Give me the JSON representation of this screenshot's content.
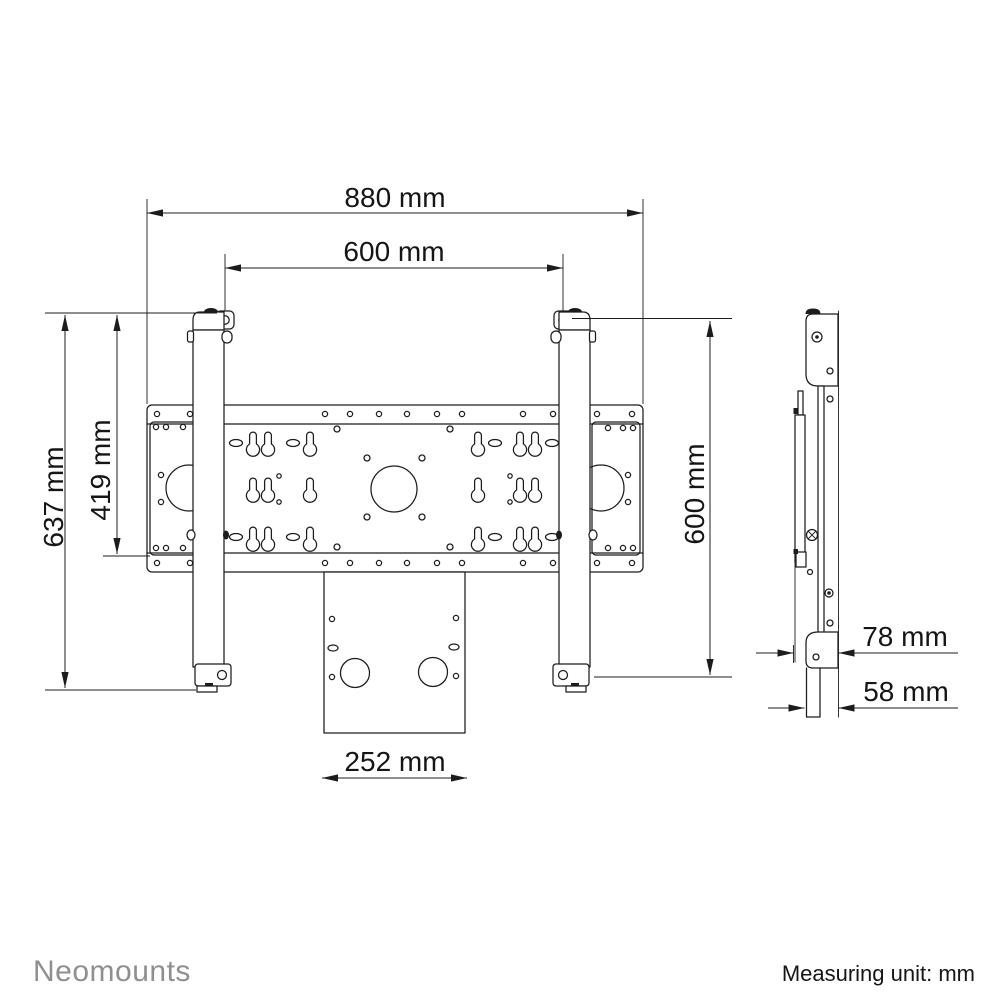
{
  "footer": {
    "brand": "Neomounts",
    "measuring_unit": "Measuring unit: mm"
  },
  "dimensions": {
    "overall_width": "880 mm",
    "hole_pattern_width": "600 mm",
    "overall_height_left": "637 mm",
    "inner_height_left": "419 mm",
    "overall_height_right": "600 mm",
    "bottom_bracket_width": "252 mm",
    "depth_to_wall": "78 mm",
    "profile_depth": "58 mm"
  }
}
